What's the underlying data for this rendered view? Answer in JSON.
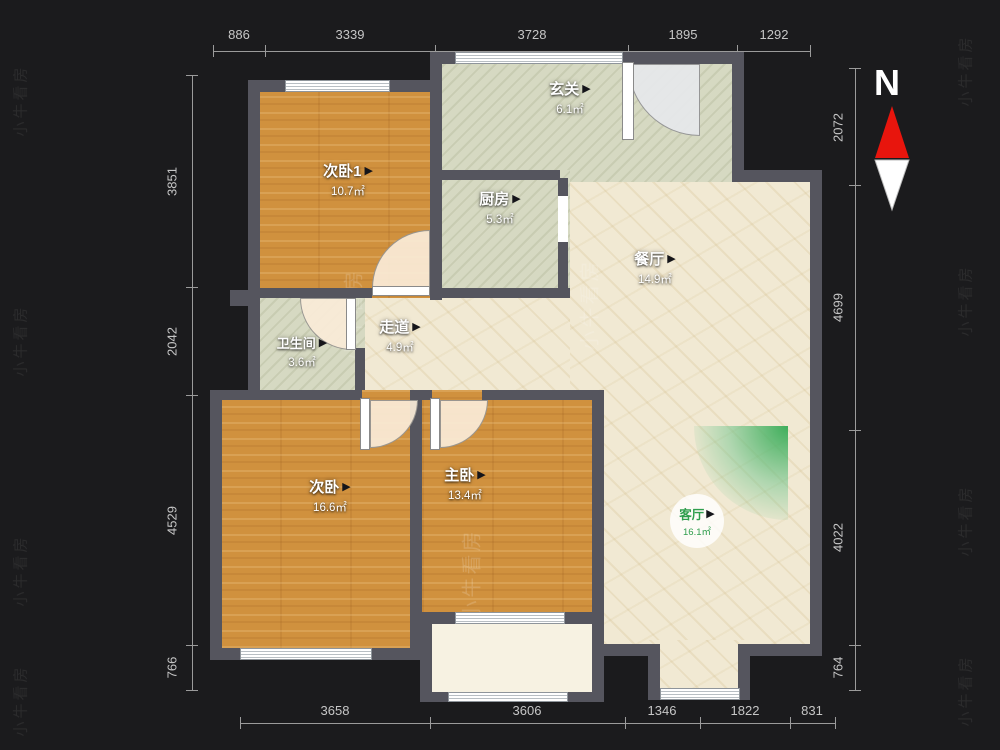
{
  "brand": "小牛看房",
  "compass": {
    "north_label": "N"
  },
  "icons": {
    "arrow": "▶"
  },
  "colors": {
    "background": "#1b1b1d",
    "wall": "#55555e",
    "wood_floor": "#d0913e",
    "sage_floor": "#d6d9c2",
    "beige_floor": "#f1e9d3",
    "accent_green": "#3fae5b",
    "north_red": "#e8150d",
    "dim_text": "#c6c6c6"
  },
  "dimensions": {
    "top": [
      "886",
      "3339",
      "3728",
      "1895",
      "1292"
    ],
    "bottom": [
      "3658",
      "3606",
      "1346",
      "1822",
      "831"
    ],
    "left": [
      "3851",
      "2042",
      "4529",
      "766"
    ],
    "right": [
      "2072",
      "4699",
      "4022",
      "764"
    ]
  },
  "rooms": {
    "bedroom1": {
      "name": "次卧1",
      "area": "10.7㎡"
    },
    "entry": {
      "name": "玄关",
      "area": "6.1㎡"
    },
    "kitchen": {
      "name": "厨房",
      "area": "5.3㎡"
    },
    "dining": {
      "name": "餐厅",
      "area": "14.9㎡"
    },
    "corridor": {
      "name": "走道",
      "area": "4.9㎡"
    },
    "bathroom": {
      "name": "卫生间",
      "area": "3.6㎡"
    },
    "bedroom2": {
      "name": "次卧",
      "area": "16.6㎡"
    },
    "master": {
      "name": "主卧",
      "area": "13.4㎡"
    },
    "living": {
      "name": "客厅",
      "area": "16.1㎡"
    }
  }
}
